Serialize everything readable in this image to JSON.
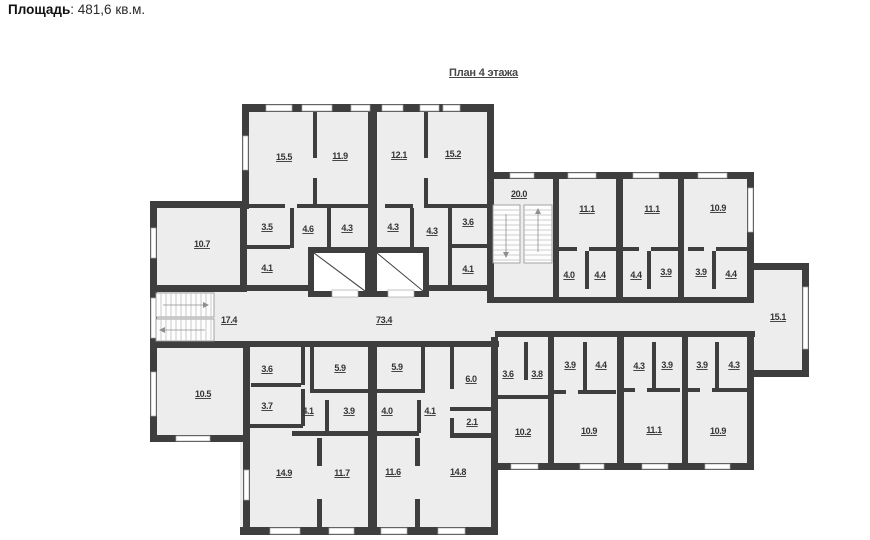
{
  "header": {
    "label": "Площадь",
    "value": ": 481,6 кв.м."
  },
  "plan": {
    "title": "План 4 этажа",
    "watermark": "АРР",
    "areas": {
      "a1": "15.5",
      "a2": "11.9",
      "a3": "12.1",
      "a4": "15.2",
      "a5": "3.5",
      "a6": "4.6",
      "a7": "4.3",
      "a8": "4.3",
      "a9": "4.3",
      "a10": "3.6",
      "a11": "4.1",
      "a12": "4.1",
      "a13": "10.7",
      "a14": "17.4",
      "a15": "73.4",
      "a16": "20.0",
      "a17": "11.1",
      "a18": "11.1",
      "a19": "10.9",
      "a20": "4.0",
      "a21": "4.4",
      "a22": "4.4",
      "a23": "3.9",
      "a24": "3.9",
      "a25": "4.4",
      "a26": "15.1",
      "a27": "10.5",
      "a28": "3.6",
      "a29": "3.7",
      "a30": "5.9",
      "a31": "5.9",
      "a32": "4.1",
      "a33": "3.9",
      "a34": "4.0",
      "a35": "4.1",
      "a36": "6.0",
      "a37": "2.1",
      "a38": "14.9",
      "a39": "11.7",
      "a40": "11.6",
      "a41": "14.8",
      "a42": "3.6",
      "a43": "3.8",
      "a44": "3.9",
      "a45": "4.4",
      "a46": "4.3",
      "a47": "3.9",
      "a48": "3.9",
      "a49": "4.3",
      "a50": "10.2",
      "a51": "10.9",
      "a52": "11.1",
      "a53": "10.9"
    }
  },
  "colors": {
    "wall": "#3e3e3e",
    "floor": "#ededed",
    "label_text": "#343434",
    "background": "#ffffff"
  }
}
